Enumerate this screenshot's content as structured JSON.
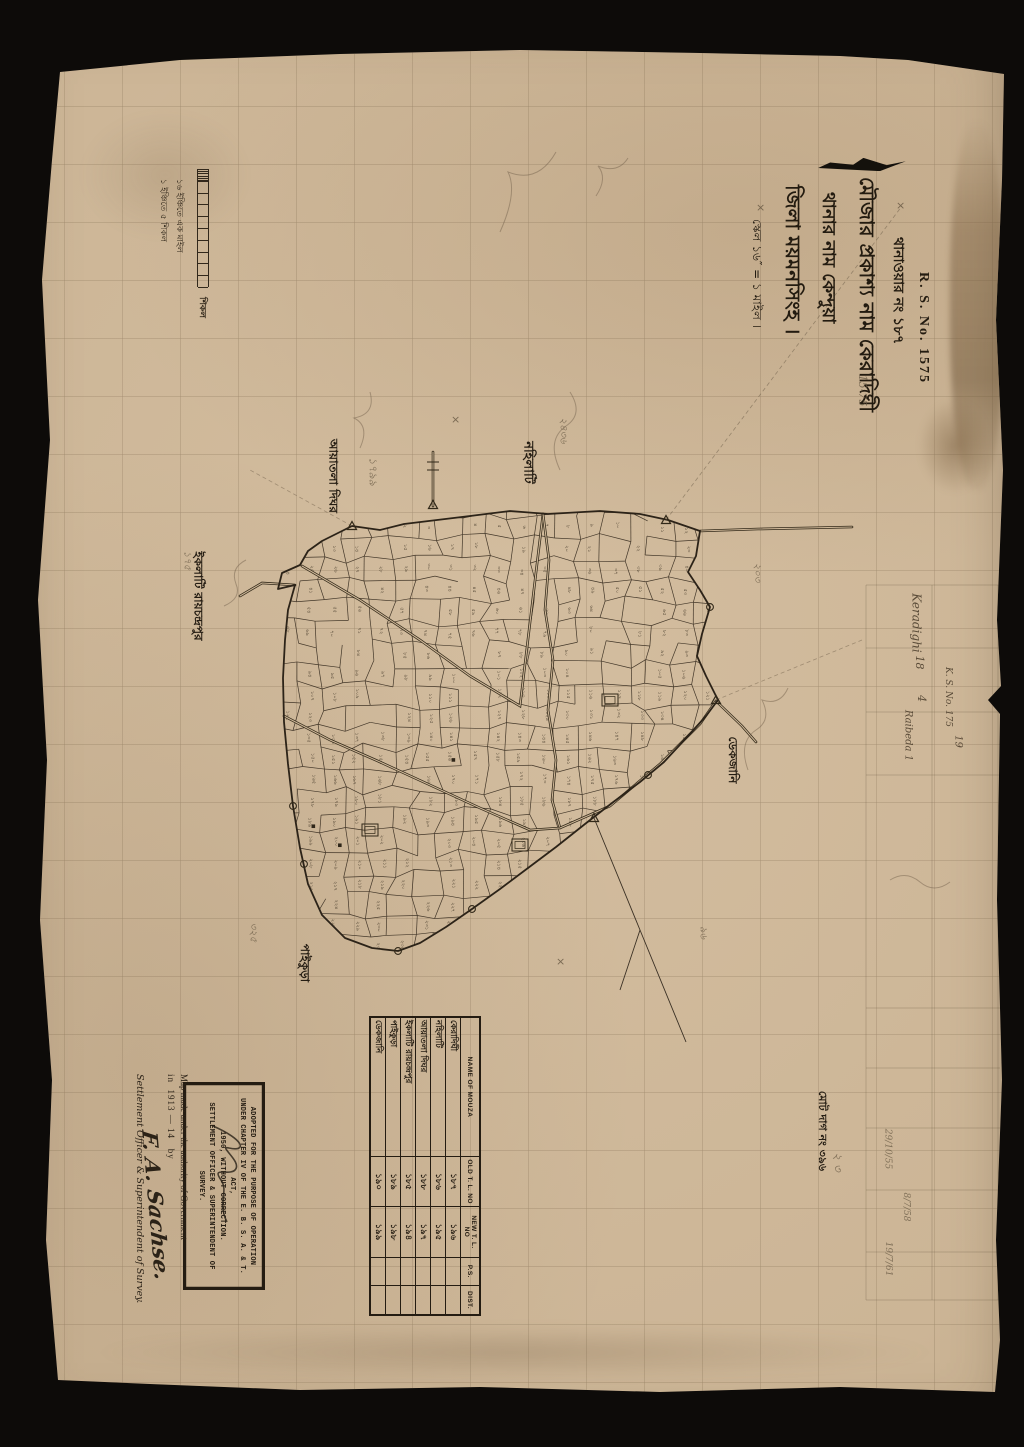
{
  "title_block": {
    "rs_no": "R. S. No. 1575",
    "lines": [
      "থানাওয়ার নং ১৮৭",
      "মৌজার প্রকাশ্য নাম কেরাদিঘী",
      "থানার নাম কেন্দুয়া",
      "জিলা ময়মনসিংহ ।"
    ],
    "scale_line": "স্কেল ১৬″ = ১ মাইল ।"
  },
  "scale_bar": {
    "notes": [
      "১৬ ইঞ্চিতে এক মাইল",
      "১ ইঞ্চিতে ৫ শিকল"
    ],
    "unit_label": "শিকল",
    "rungs": 10
  },
  "neighbour_mouzas": [
    {
      "label": "নহিলাটি",
      "x": 527,
      "y": 462,
      "size": 13
    },
    {
      "label": "আয়াতলা দিঘর",
      "x": 332,
      "y": 476,
      "size": 12
    },
    {
      "label": "ইকলাটি রায়চন্দ্রপুর",
      "x": 196,
      "y": 596,
      "size": 12
    },
    {
      "label": "পাইকুড়া",
      "x": 303,
      "y": 963,
      "size": 12
    },
    {
      "label": "ডেকজানি",
      "x": 731,
      "y": 760,
      "size": 12
    }
  ],
  "total_dag_note": "মোট দাগ নং ৩৯৬",
  "table": {
    "headers": [
      "NAME OF MOUZA",
      "OLD T. L. NO",
      "NEW T. L. NO",
      "P.S.",
      "DIST."
    ],
    "rows": [
      {
        "name": "কেরাদিঘী",
        "old": "১৮৭",
        "new": "১৯৬",
        "ps": "",
        "dist": ""
      },
      {
        "name": "নহিলাটি",
        "old": "১৮৬",
        "new": "১৯৫",
        "ps": "",
        "dist": ""
      },
      {
        "name": "আয়াতলা দিঘর",
        "old": "১৮৮",
        "new": "১৯৭",
        "ps": "",
        "dist": ""
      },
      {
        "name": "ইকলাটি রায়চন্দ্রপুর",
        "old": "১৮৫",
        "new": "১৯৪",
        "ps": "",
        "dist": ""
      },
      {
        "name": "পাইকুড়া",
        "old": "১৮৯",
        "new": "১৯৮",
        "ps": "",
        "dist": ""
      },
      {
        "name": "ডেকজানি",
        "old": "১৯০",
        "new": "১৯৯",
        "ps": "",
        "dist": ""
      }
    ]
  },
  "stamp": {
    "lines": [
      "ADOPTED FOR THE PURPOSE OF OPERATION",
      "UNDER CHAPTER IV OF THE E. B. S. A. & T. ACT,",
      "1950, WITHOUT CORRECTION.",
      "SETTLEMENT OFFICER & SUPERINTENDENT OF",
      "SURVEY."
    ]
  },
  "attribution": {
    "line1": "Map made under the authority of Government",
    "prefix": "in",
    "years": "1913 — 14",
    "by": "by",
    "signature": "F. A. Sachse.",
    "line3": "Settlement Officer & Superintendent of Survey."
  },
  "handwritten": [
    {
      "text": "Keradighi",
      "x": 916,
      "y": 624,
      "size": 12,
      "style": "pen"
    },
    {
      "text": "18",
      "x": 920,
      "y": 664,
      "size": 11,
      "style": "pen"
    },
    {
      "text": "4",
      "x": 921,
      "y": 700,
      "size": 11,
      "style": "pen"
    },
    {
      "text": "Raibeda 1",
      "x": 908,
      "y": 738,
      "size": 10,
      "style": "pen"
    },
    {
      "text": "19",
      "x": 958,
      "y": 744,
      "size": 10,
      "style": "pen"
    },
    {
      "text": "K. S. No. 175",
      "x": 948,
      "y": 700,
      "size": 9,
      "style": "pen"
    },
    {
      "text": "29/10/55",
      "x": 888,
      "y": 1152,
      "size": 9,
      "style": "pencil"
    },
    {
      "text": "8/7/58",
      "x": 906,
      "y": 1210,
      "size": 9,
      "style": "pencil"
    },
    {
      "text": "19/7/61",
      "x": 888,
      "y": 1262,
      "size": 9,
      "style": "pencil"
    },
    {
      "text": "15-75",
      "x": 862,
      "y": 392,
      "size": 11,
      "style": "pencil"
    },
    {
      "text": "১৭৯৯",
      "x": 372,
      "y": 470,
      "size": 11,
      "style": "pencil"
    },
    {
      "text": "২৪৩৬",
      "x": 562,
      "y": 430,
      "size": 10,
      "style": "pencil"
    },
    {
      "text": "৩২৫",
      "x": 252,
      "y": 932,
      "size": 10,
      "style": "pencil"
    },
    {
      "text": "১৭৫",
      "x": 186,
      "y": 560,
      "size": 10,
      "style": "pencil"
    },
    {
      "text": "২০৩",
      "x": 756,
      "y": 572,
      "size": 10,
      "style": "pencil"
    },
    {
      "text": "৯৬",
      "x": 702,
      "y": 932,
      "size": 10,
      "style": "pencil"
    },
    {
      "text": "২ ৩",
      "x": 836,
      "y": 1160,
      "size": 12,
      "style": "pencil"
    }
  ],
  "cross_marks": [
    {
      "x": 900,
      "y": 206
    },
    {
      "x": 760,
      "y": 208
    },
    {
      "x": 455,
      "y": 420
    },
    {
      "x": 560,
      "y": 962
    }
  ],
  "map": {
    "total_dags": 396,
    "outline": [
      [
        322,
        541
      ],
      [
        352,
        526
      ],
      [
        380,
        530
      ],
      [
        404,
        524
      ],
      [
        470,
        516
      ],
      [
        510,
        511
      ],
      [
        548,
        514
      ],
      [
        600,
        511
      ],
      [
        640,
        514
      ],
      [
        668,
        520
      ],
      [
        700,
        531
      ],
      [
        696,
        556
      ],
      [
        688,
        572
      ],
      [
        700,
        590
      ],
      [
        710,
        607
      ],
      [
        702,
        634
      ],
      [
        697,
        656
      ],
      [
        706,
        676
      ],
      [
        718,
        700
      ],
      [
        706,
        716
      ],
      [
        688,
        736
      ],
      [
        664,
        762
      ],
      [
        640,
        782
      ],
      [
        612,
        803
      ],
      [
        585,
        824
      ],
      [
        556,
        847
      ],
      [
        528,
        868
      ],
      [
        500,
        889
      ],
      [
        472,
        909
      ],
      [
        446,
        927
      ],
      [
        420,
        943
      ],
      [
        398,
        951
      ],
      [
        372,
        948
      ],
      [
        345,
        938
      ],
      [
        322,
        915
      ],
      [
        308,
        884
      ],
      [
        300,
        848
      ],
      [
        293,
        806
      ],
      [
        288,
        764
      ],
      [
        284,
        722
      ],
      [
        283,
        678
      ],
      [
        285,
        640
      ],
      [
        288,
        610
      ],
      [
        295,
        585
      ],
      [
        278,
        589
      ],
      [
        282,
        573
      ],
      [
        300,
        565
      ],
      [
        308,
        551
      ]
    ],
    "roads": [
      [
        [
          302,
          566
        ],
        [
          360,
          600
        ],
        [
          420,
          640
        ],
        [
          470,
          676
        ],
        [
          520,
          706
        ],
        [
          543,
          514
        ]
      ],
      [
        [
          543,
          514
        ],
        [
          549,
          560
        ],
        [
          545,
          610
        ],
        [
          553,
          660
        ],
        [
          548,
          710
        ],
        [
          556,
          760
        ],
        [
          552,
          800
        ],
        [
          560,
          828
        ]
      ],
      [
        [
          284,
          716
        ],
        [
          330,
          740
        ],
        [
          380,
          762
        ],
        [
          430,
          785
        ],
        [
          480,
          808
        ],
        [
          530,
          830
        ],
        [
          560,
          828
        ],
        [
          610,
          806
        ],
        [
          660,
          764
        ],
        [
          700,
          724
        ],
        [
          716,
          701
        ]
      ],
      [
        [
          433,
          506
        ],
        [
          433,
          452
        ]
      ],
      [
        [
          295,
          585
        ],
        [
          262,
          583
        ],
        [
          240,
          596
        ]
      ],
      [
        [
          700,
          531
        ],
        [
          758,
          529
        ],
        [
          852,
          527
        ]
      ],
      [
        [
          716,
          701
        ],
        [
          742,
          726
        ],
        [
          756,
          742
        ]
      ]
    ],
    "stray_lines": [
      [
        [
          594,
          818
        ],
        [
          640,
          930
        ],
        [
          686,
          1042
        ]
      ],
      [
        [
          640,
          930
        ],
        [
          620,
          990
        ]
      ]
    ],
    "triangles": [
      [
        352,
        526
      ],
      [
        433,
        505
      ],
      [
        666,
        520
      ],
      [
        716,
        700
      ],
      [
        594,
        818
      ]
    ],
    "circles": [
      [
        293,
        806
      ],
      [
        398,
        951
      ],
      [
        472,
        909
      ],
      [
        304,
        864
      ],
      [
        648,
        775
      ],
      [
        710,
        607
      ]
    ]
  }
}
